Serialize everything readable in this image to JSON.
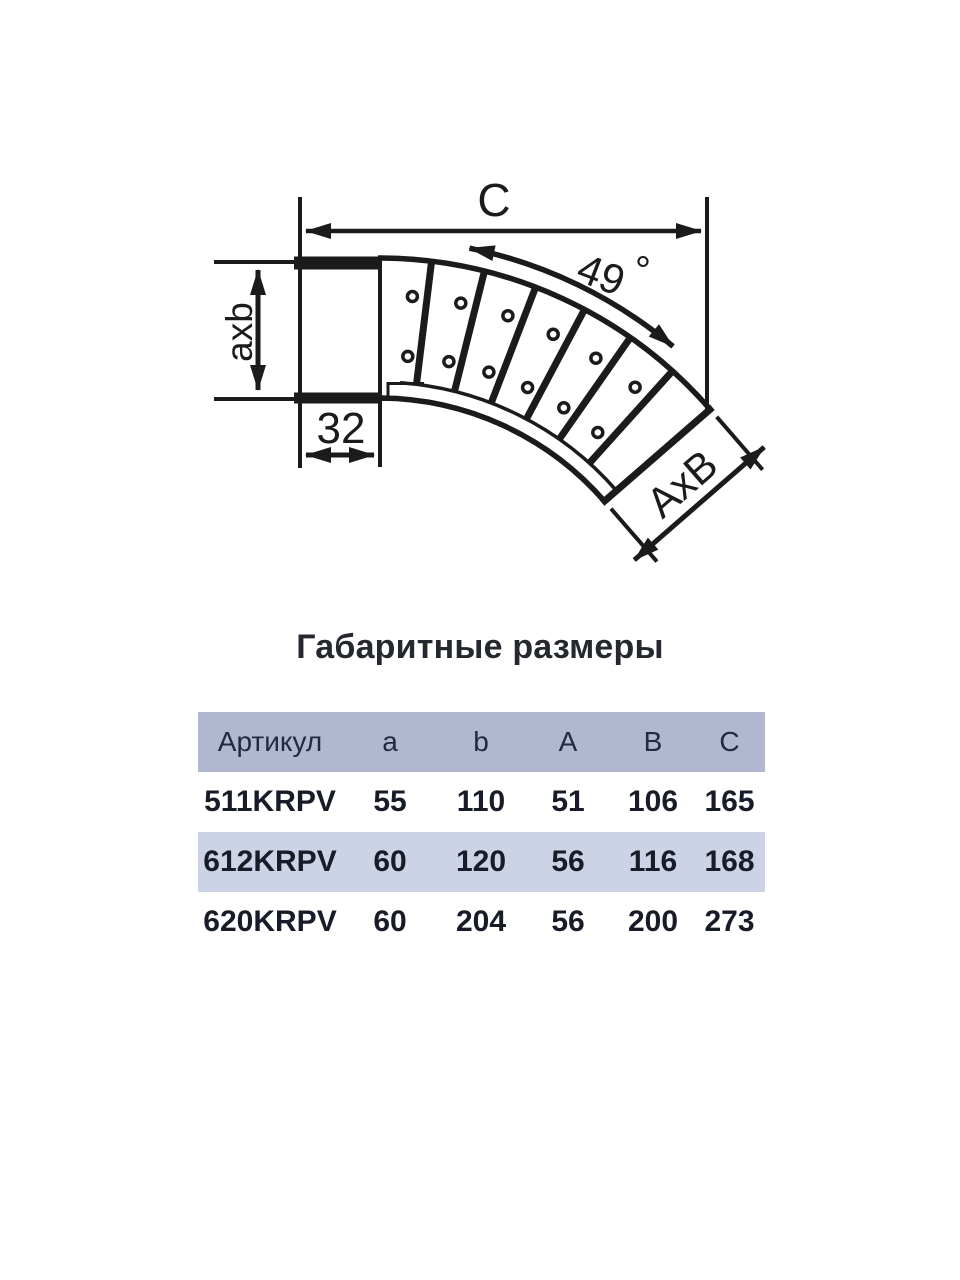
{
  "page": {
    "background": "#ffffff"
  },
  "diagram": {
    "stroke_color": "#1b1b1b",
    "labels": {
      "c": "C",
      "angle_value": "49",
      "angle_degree": "°",
      "inlet_section": "axb",
      "connector_depth": "32",
      "outlet_section": "AxB"
    }
  },
  "section": {
    "title": "Габаритные размеры"
  },
  "table": {
    "colors": {
      "header_bg": "#b1b7d0",
      "alt_row_bg": "#cdd3e7",
      "text": "#181c28"
    },
    "columns": [
      "Артикул",
      "a",
      "b",
      "A",
      "B",
      "C"
    ],
    "rows": [
      {
        "article": "511KRPV",
        "a": "55",
        "b": "110",
        "A": "51",
        "B": "106",
        "C": "165"
      },
      {
        "article": "612KRPV",
        "a": "60",
        "b": "120",
        "A": "56",
        "B": "116",
        "C": "168"
      },
      {
        "article": "620KRPV",
        "a": "60",
        "b": "204",
        "A": "56",
        "B": "200",
        "C": "273"
      }
    ]
  }
}
